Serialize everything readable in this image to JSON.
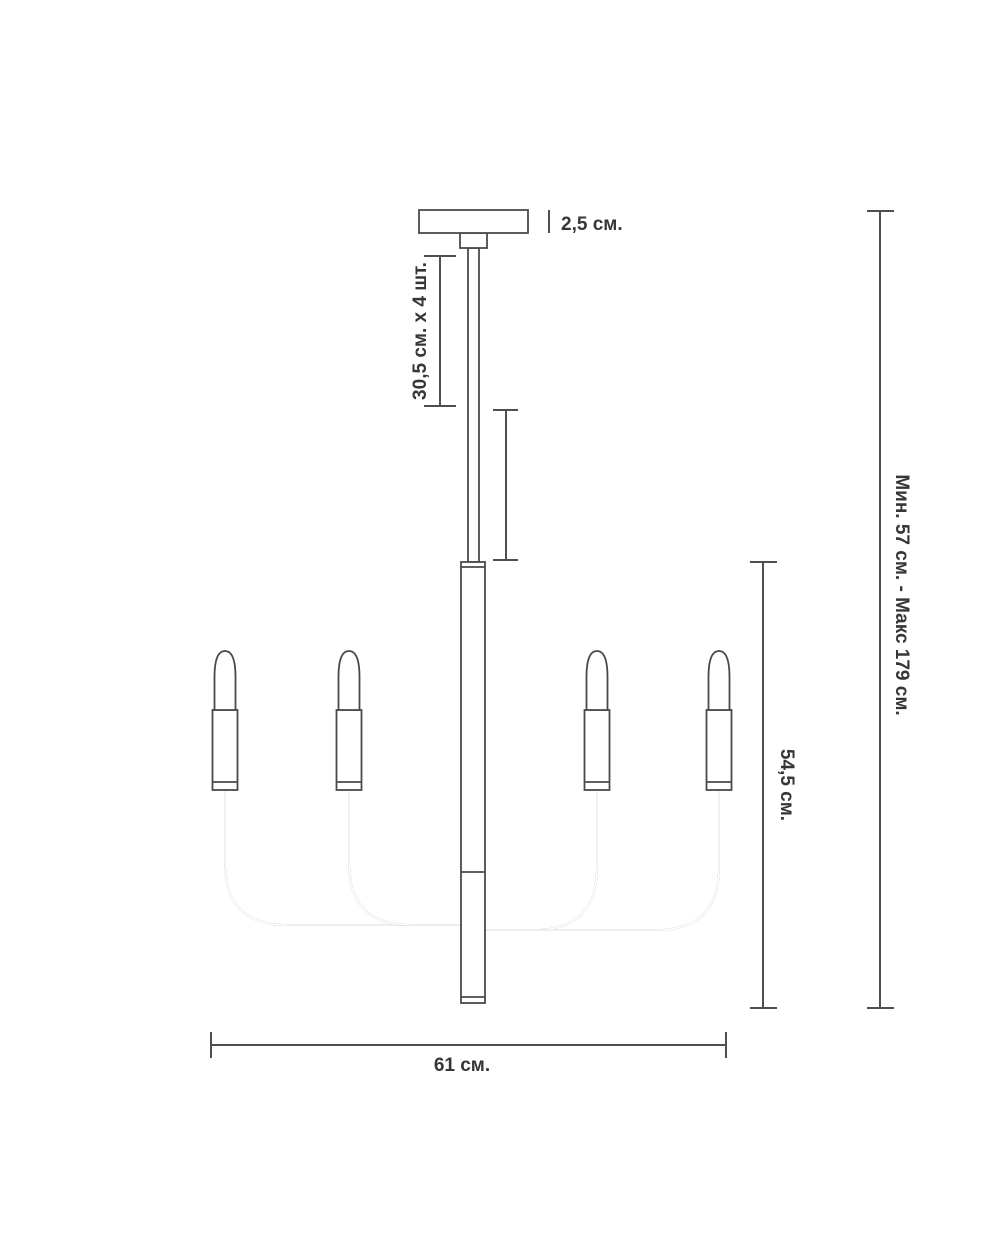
{
  "page": {
    "title": "Chandelier dimension drawing",
    "background": "#ffffff"
  },
  "drawing": {
    "subject": "4-arm chandelier technical outline",
    "lamp_count": 4,
    "line_color": "#4a4a4a",
    "dim_color": "#4f4f4f",
    "text_color": "#363636",
    "fill_color": "#ffffff"
  },
  "labels": {
    "canopy_height": "2,5 см.",
    "rod_section": "30,5 см. х 4 шт.",
    "body_height": "54,5 см.",
    "overall_height": "Мин. 57 см. - Макс 179 см.",
    "width": "61 см."
  }
}
